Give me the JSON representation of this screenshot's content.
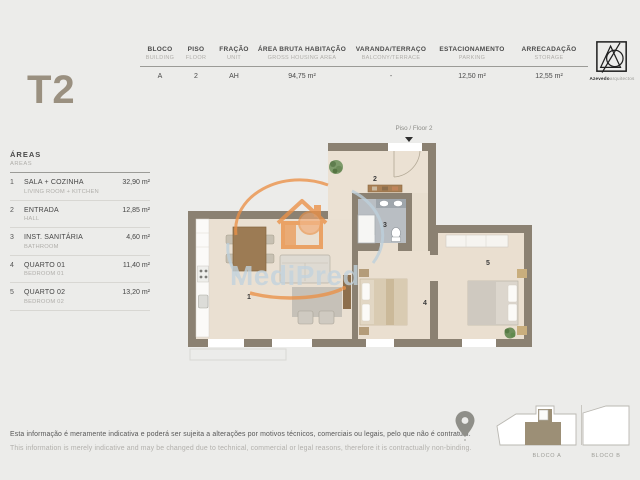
{
  "title": "T2",
  "logo": {
    "bold": "Azevedo",
    "light": "arquitectos",
    "icon": "triangle-circle-monogram"
  },
  "spec": {
    "columns": [
      {
        "pt": "BLOCO",
        "en": "BUILDING",
        "value": "A"
      },
      {
        "pt": "PISO",
        "en": "FLOOR",
        "value": "2"
      },
      {
        "pt": "FRAÇÃO",
        "en": "UNIT",
        "value": "AH"
      },
      {
        "pt": "ÁREA BRUTA HABITAÇÃO",
        "en": "GROSS HOUSING AREA",
        "value": "94,75 m²"
      },
      {
        "pt": "VARANDA/TERRAÇO",
        "en": "BALCONY/TERRACE",
        "value": "-"
      },
      {
        "pt": "ESTACIONAMENTO",
        "en": "PARKING",
        "value": "12,50 m²"
      },
      {
        "pt": "ARRECADAÇÃO",
        "en": "STORAGE",
        "value": "12,55 m²"
      }
    ]
  },
  "areas": {
    "title_pt": "ÁREAS",
    "title_en": "AREAS",
    "rows": [
      {
        "num": "1",
        "pt": "SALA + COZINHA",
        "en": "LIVING ROOM + KITCHEN",
        "value": "32,90 m²"
      },
      {
        "num": "2",
        "pt": "ENTRADA",
        "en": "HALL",
        "value": "12,85 m²"
      },
      {
        "num": "3",
        "pt": "INST. SANITÁRIA",
        "en": "BATHROOM",
        "value": "4,60 m²"
      },
      {
        "num": "4",
        "pt": "QUARTO 01",
        "en": "BEDROOM 01",
        "value": "11,40 m²"
      },
      {
        "num": "5",
        "pt": "QUARTO 02",
        "en": "BEDROOM 02",
        "value": "13,20 m²"
      }
    ]
  },
  "plan": {
    "floor_label": "Piso / Floor 2",
    "rooms": {
      "r1": "1",
      "r2": "2",
      "r3": "3",
      "r4": "4",
      "r5": "5"
    },
    "watermark": "MediPred"
  },
  "keyplan": {
    "bloco_a": "BLOCO A",
    "bloco_b": "BLOCO B"
  },
  "disclaimer": {
    "pt": "Esta informação é meramente indicativa e poderá ser sujeita a alterações por motivos técnicos, comerciais ou legais, pelo que não é contratual.",
    "en": "This information is merely indicative and may be changed due to technical, commercial or legal reasons, therefore it is contractually non-binding."
  },
  "colors": {
    "background": "#ececea",
    "accent_taupe": "#9a9080",
    "wall": "#8b8172",
    "floor": "#eae0d2",
    "bathroom_tile": "#b9bec3",
    "watermark_orange": "#eb9147",
    "watermark_blue": "#c2d3de",
    "keyplan_highlight": "#9c8f76"
  }
}
